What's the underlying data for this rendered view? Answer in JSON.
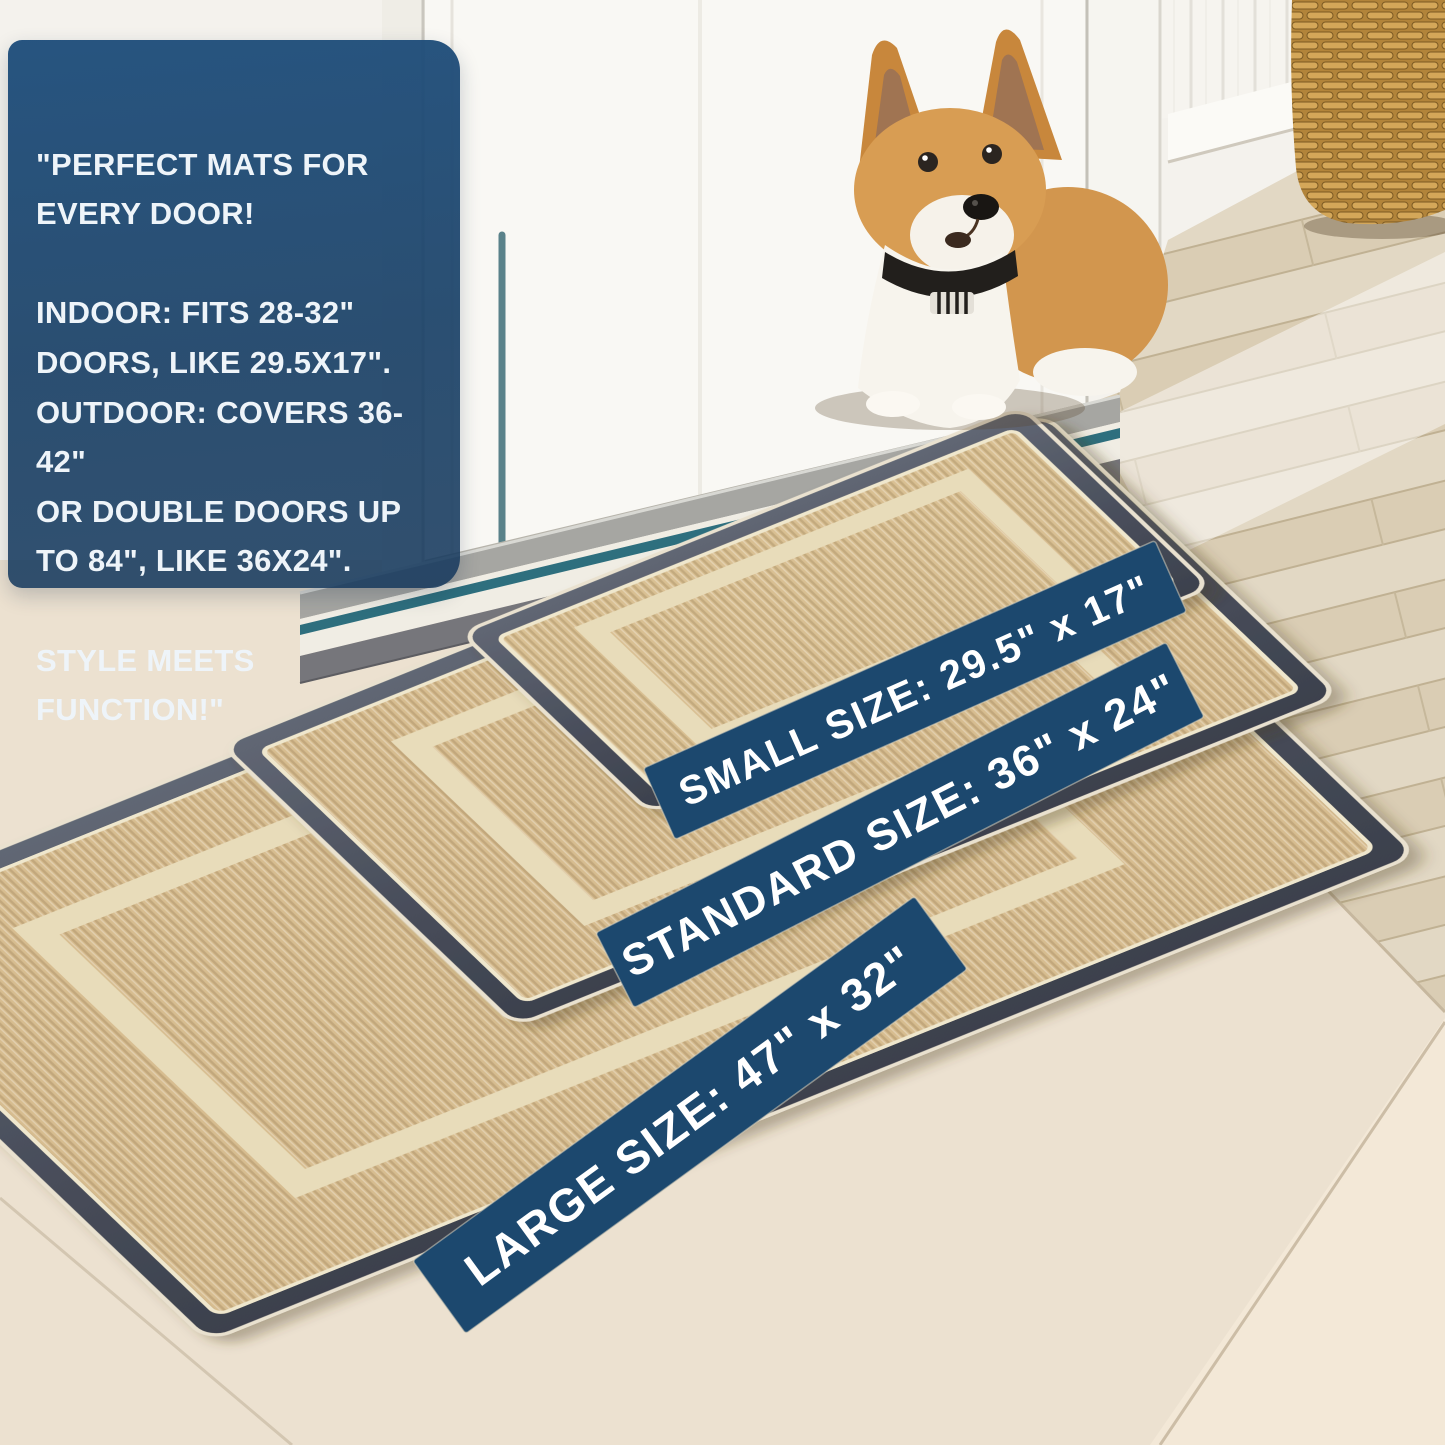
{
  "image_type": "doormat-product-photo",
  "info_box": {
    "text": "\"PERFECT MATS FOR\nEVERY DOOR!\n\nINDOOR: FITS 28-32\"\nDOORS, LIKE 29.5X17\".\nOUTDOOR: COVERS 36-42\"\nOR DOUBLE DOORS UP\nTO 84\", LIKE 36X24\".\n\nSTYLE MEETS FUNCTION!\"",
    "bg_color": "#1e4c78",
    "text_color": "#eef4f9"
  },
  "size_banners": {
    "bg_color": "#1c486e",
    "text_color": "#ffffff",
    "small": {
      "label": "SMALL SIZE: 29.5\" x 17\""
    },
    "standard": {
      "label": "STANDARD SIZE: 36\" x 24\""
    },
    "large": {
      "label": "LARGE SIZE: 47\" x 32\""
    }
  },
  "scene": {
    "subject": "corgi dog sitting at an open white door",
    "objects": [
      "white-door",
      "beadboard-wall",
      "wicker-basket",
      "door-threshold",
      "small-doormat",
      "standard-doormat",
      "large-doormat",
      "wood-floor",
      "tile-floor"
    ],
    "mat_colors": {
      "carpet": "#d7bd90",
      "border": "#4a4f5c",
      "binding": "#efe7cd",
      "inner_ring": "#e8dcba"
    }
  }
}
